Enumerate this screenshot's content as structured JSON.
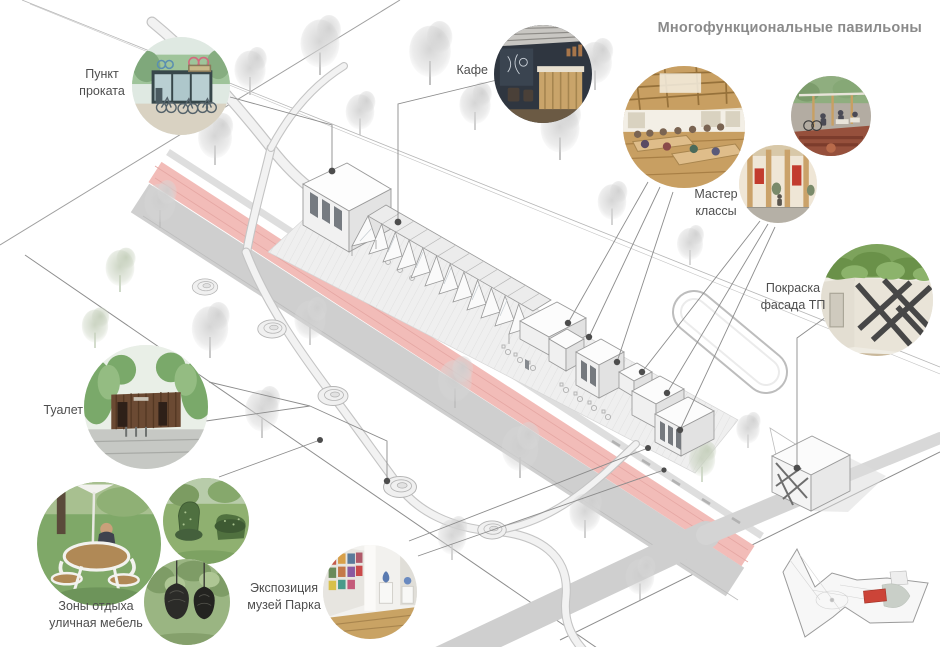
{
  "title": "Многофункциональные павильоны",
  "labels": {
    "rental": "Пункт\nпроката",
    "cafe": "Кафе",
    "workshops": "Мастер\nклассы",
    "facade": "Покраска\nфасада ТП",
    "toilet": "Туалет",
    "rest": "Зоны отдыха\nуличная мебель",
    "museum": "Экспозиция\nмузей Парка"
  },
  "colors": {
    "title-gray": "#8a8a8a",
    "label-gray": "#4e4e4e",
    "road-pink": "#f2bcb8",
    "road-gray": "#cfcfcf",
    "keyplan-red": "#cc4438",
    "leader-gray": "#8c8c8c",
    "dot-gray": "#4d4d4d"
  },
  "plan": {
    "description": "isometric park site plan with pavilion row, pink path, paths, trees",
    "keyplan_highlight": "red rectangle marks pavilion row location"
  }
}
